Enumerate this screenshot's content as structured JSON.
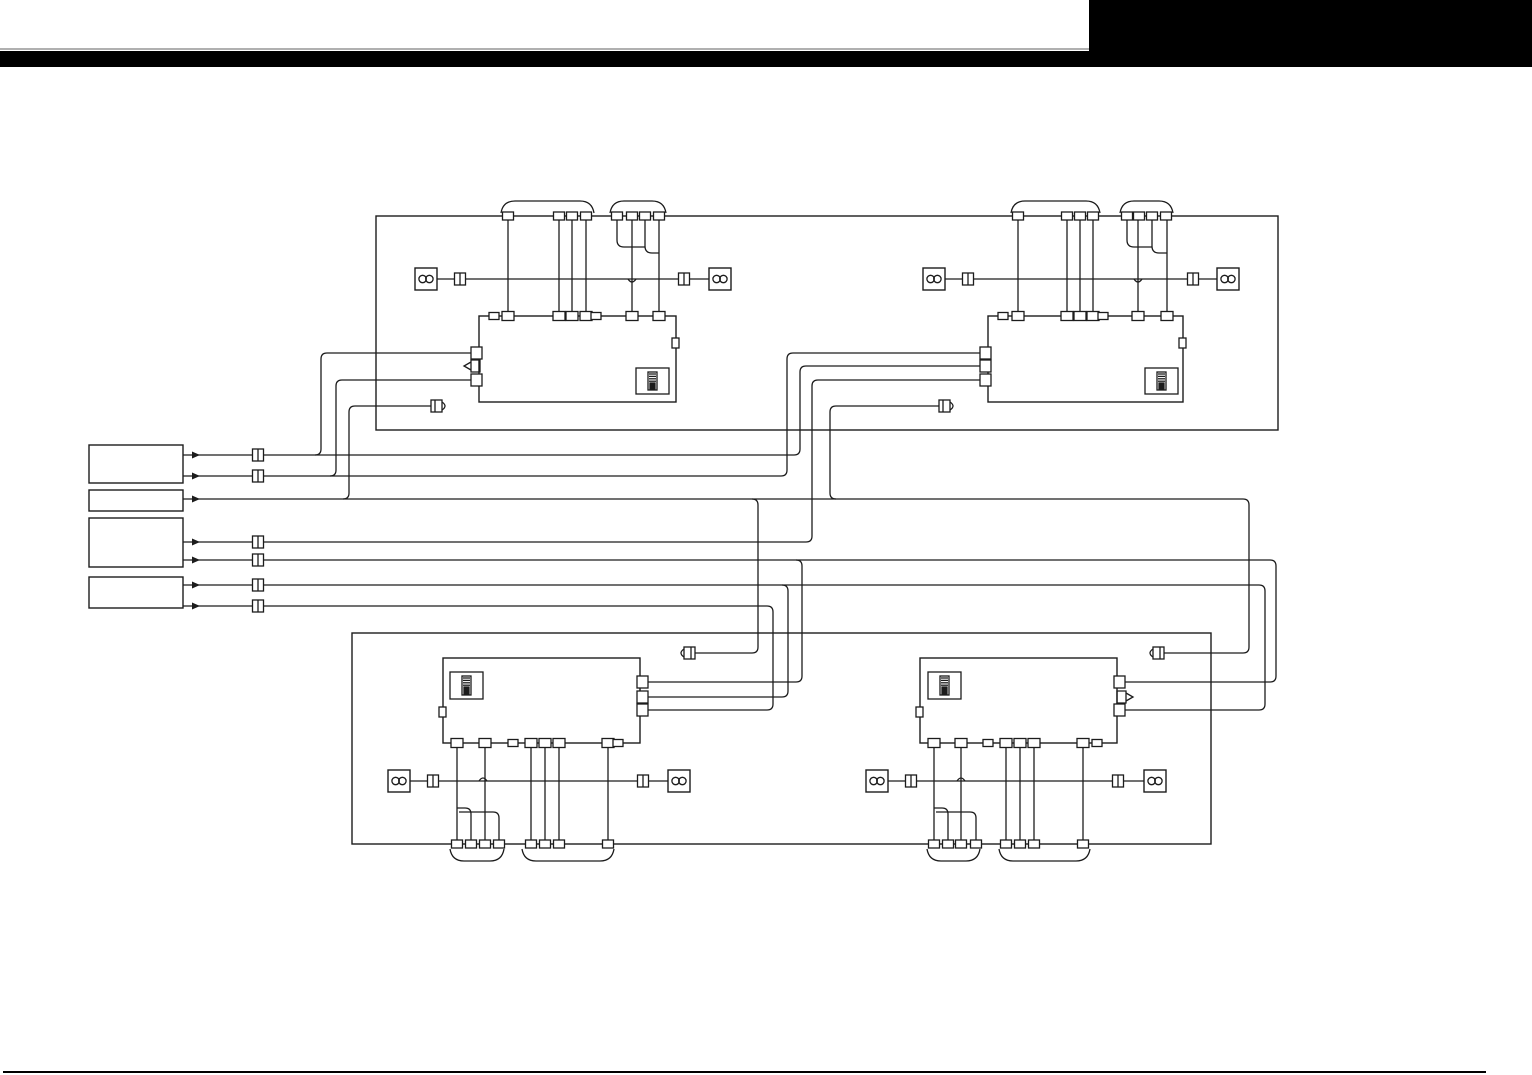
{
  "meta": {
    "width": 1532,
    "height": 1075,
    "description": "speaker-system-wiring-diagram"
  },
  "colors": {
    "background": "#ffffff",
    "line": "#1c1c1c",
    "header_black": "#000000",
    "rule_gray": "#b0b0b0"
  },
  "header": {
    "blocks": [
      {
        "name": "header-gray-rule",
        "x": 0,
        "y": 48,
        "w": 1089,
        "h": 2,
        "color": "#b0b0b0"
      },
      {
        "name": "header-black-bar",
        "x": 0,
        "y": 51,
        "w": 1532,
        "h": 16,
        "color": "#000000"
      },
      {
        "name": "header-corner-block",
        "x": 1089,
        "y": 0,
        "w": 443,
        "h": 67,
        "color": "#000000"
      }
    ]
  },
  "footer": {
    "blocks": [
      {
        "name": "footer-rule",
        "x": 3,
        "y": 1071,
        "w": 1483,
        "h": 2,
        "color": "#000000"
      }
    ]
  },
  "diagram": {
    "frames": [
      {
        "name": "top-harness-frame",
        "x": 376,
        "y": 216,
        "w": 902,
        "h": 214
      },
      {
        "name": "bottom-harness-frame",
        "x": 352,
        "y": 633,
        "w": 859,
        "h": 211
      }
    ],
    "units": [
      {
        "name": "unit-top-left",
        "x": 479,
        "y": 316,
        "w": 197,
        "h": 86,
        "inner_box": {
          "x": 636,
          "y": 368,
          "w": 33,
          "h": 26
        },
        "side_tab": {
          "x": 672,
          "y": 338,
          "w": 7,
          "h": 10
        }
      },
      {
        "name": "unit-top-right",
        "x": 988,
        "y": 316,
        "w": 195,
        "h": 86,
        "inner_box": {
          "x": 1145,
          "y": 368,
          "w": 33,
          "h": 26
        },
        "side_tab": {
          "x": 1179,
          "y": 338,
          "w": 7,
          "h": 10
        }
      },
      {
        "name": "unit-bottom-left",
        "x": 443,
        "y": 658,
        "w": 197,
        "h": 85,
        "inner_box": {
          "x": 450,
          "y": 672,
          "w": 33,
          "h": 27
        },
        "side_tab": {
          "x": 439,
          "y": 707,
          "w": 7,
          "h": 10
        }
      },
      {
        "name": "unit-bottom-right",
        "x": 920,
        "y": 658,
        "w": 197,
        "h": 85,
        "inner_box": {
          "x": 928,
          "y": 672,
          "w": 33,
          "h": 27
        },
        "side_tab": {
          "x": 916,
          "y": 707,
          "w": 7,
          "h": 10
        }
      }
    ],
    "source_boxes": [
      {
        "name": "source-box-1",
        "x": 89,
        "y": 445,
        "w": 94,
        "h": 38
      },
      {
        "name": "source-box-2",
        "x": 89,
        "y": 490,
        "w": 94,
        "h": 21
      },
      {
        "name": "source-box-3",
        "x": 89,
        "y": 518,
        "w": 94,
        "h": 49
      },
      {
        "name": "source-box-4",
        "x": 89,
        "y": 577,
        "w": 94,
        "h": 31
      }
    ],
    "wires": [
      {
        "name": "wire-tl-pin-a1",
        "d": "M508,216 V316"
      },
      {
        "name": "wire-tl-pin-a2",
        "d": "M559,216 V316"
      },
      {
        "name": "wire-tl-pin-a3",
        "d": "M572,216 V316"
      },
      {
        "name": "wire-tl-pin-a4",
        "d": "M586,216 V316"
      },
      {
        "name": "wire-tl-pin-b2",
        "d": "M632,216 V316"
      },
      {
        "name": "wire-tl-pin-b4",
        "d": "M659,216 V316"
      },
      {
        "name": "wire-tl-pin-b1-merge",
        "d": "M617,216 V240 Q617,247 624,247 H645"
      },
      {
        "name": "wire-tl-pin-b3-merge",
        "d": "M645,216 V246 Q645,253 652,253 H659"
      },
      {
        "name": "wire-tr-pin-a1",
        "d": "M1018,216 V316"
      },
      {
        "name": "wire-tr-pin-a2",
        "d": "M1067,216 V316"
      },
      {
        "name": "wire-tr-pin-a3",
        "d": "M1080,216 V316"
      },
      {
        "name": "wire-tr-pin-a4",
        "d": "M1093,216 V316"
      },
      {
        "name": "wire-tr-pin-b2",
        "d": "M1138,216 V316"
      },
      {
        "name": "wire-tr-pin-b4",
        "d": "M1167,216 V316"
      },
      {
        "name": "wire-tr-pin-b1-merge",
        "d": "M1127,216 V240 Q1127,247 1134,247 H1152"
      },
      {
        "name": "wire-tr-pin-b3-merge",
        "d": "M1152,216 V246 Q1152,253 1159,253 H1167"
      },
      {
        "name": "wire-bl-pin-1",
        "d": "M457,743 V844"
      },
      {
        "name": "wire-bl-pin-3",
        "d": "M485,743 V844"
      },
      {
        "name": "wire-bl-pin-2-merge",
        "d": "M471,844 V814 Q471,808 465,808 H457"
      },
      {
        "name": "wire-bl-pin-4-merge",
        "d": "M499,844 V818 Q499,812 493,812 H459"
      },
      {
        "name": "wire-bl-pin-c1",
        "d": "M531,743 V844"
      },
      {
        "name": "wire-bl-pin-c2",
        "d": "M545,743 V844"
      },
      {
        "name": "wire-bl-pin-c3",
        "d": "M559,743 V844"
      },
      {
        "name": "wire-bl-pin-c4",
        "d": "M608,743 V844"
      },
      {
        "name": "wire-br-pin-1",
        "d": "M934,743 V844"
      },
      {
        "name": "wire-br-pin-3",
        "d": "M961,743 V844"
      },
      {
        "name": "wire-br-pin-2-merge",
        "d": "M948,844 V814 Q948,808 942,808 H934"
      },
      {
        "name": "wire-br-pin-4-merge",
        "d": "M976,844 V818 Q976,812 970,812 H936"
      },
      {
        "name": "wire-br-pin-c1",
        "d": "M1006,743 V844"
      },
      {
        "name": "wire-br-pin-c2",
        "d": "M1020,743 V844"
      },
      {
        "name": "wire-br-pin-c3",
        "d": "M1034,743 V844"
      },
      {
        "name": "wire-br-pin-c4",
        "d": "M1083,743 V844"
      },
      {
        "name": "wire-speaker-row-tl-1",
        "d": "M437,279 H455"
      },
      {
        "name": "wire-speaker-row-tl-2",
        "d": "M466,279 H679"
      },
      {
        "name": "wire-speaker-row-tl-3",
        "d": "M690,279 H709"
      },
      {
        "name": "hop-tl",
        "d": "M628,279 Q632,285 636,279"
      },
      {
        "name": "wire-speaker-row-tr-1",
        "d": "M945,279 H963"
      },
      {
        "name": "wire-speaker-row-tr-2",
        "d": "M974,279 H1188"
      },
      {
        "name": "wire-speaker-row-tr-3",
        "d": "M1199,279 H1217"
      },
      {
        "name": "hop-tr",
        "d": "M1134,279 Q1138,285 1142,279"
      },
      {
        "name": "wire-speaker-row-bl-1",
        "d": "M409,781 H428"
      },
      {
        "name": "wire-speaker-row-bl-2",
        "d": "M439,781 H638"
      },
      {
        "name": "wire-speaker-row-bl-3",
        "d": "M649,781 H668"
      },
      {
        "name": "hop-bl",
        "d": "M479,781 Q483,775 487,781"
      },
      {
        "name": "wire-speaker-row-br-1",
        "d": "M887,781 H906"
      },
      {
        "name": "wire-speaker-row-br-2",
        "d": "M917,781 H1113"
      },
      {
        "name": "wire-speaker-row-br-3",
        "d": "M1124,781 H1144"
      },
      {
        "name": "hop-br",
        "d": "M957,781 Q961,775 965,781"
      },
      {
        "name": "net-source1-line1",
        "d": "M183,455 H794 Q800,455 800,449 V372 Q800,366 806,366 H980"
      },
      {
        "name": "net-source1-line1-branch",
        "d": "M315,455 Q321,455 321,449 V359 Q321,353 327,353 H472"
      },
      {
        "name": "net-source1-line2",
        "d": "M183,476 H781 Q787,476 787,470 V359 Q787,353 793,353 H980"
      },
      {
        "name": "net-source1-line2-branch",
        "d": "M330,476 Q336,476 336,470 V386 Q336,380 342,380 H472"
      },
      {
        "name": "net-source2-main",
        "d": "M183,499 H1243 Q1249,499 1249,505 V647 Q1249,653 1243,653 H1164"
      },
      {
        "name": "net-source2-branch-tl-plug",
        "d": "M343,499 Q349,499 349,493 V412 Q349,406 355,406 H431"
      },
      {
        "name": "net-source2-branch-bl-plug",
        "d": "M752,499 Q758,499 758,505 V647 Q758,653 752,653 H695"
      },
      {
        "name": "net-source2-branch-tr-plug",
        "d": "M836,499 Q830,499 830,493 V412 Q830,406 836,406 H939"
      },
      {
        "name": "net-source3-line1",
        "d": "M183,542 H806 Q812,542 812,536 V386 Q812,380 818,380 H980"
      },
      {
        "name": "net-source3-line2",
        "d": "M183,560 H1270 Q1276,560 1276,566 V676 Q1276,682 1270,682 H1124"
      },
      {
        "name": "net-source3-line2-branch",
        "d": "M796,560 Q802,560 802,566 V676 Q802,682 796,682 H646"
      },
      {
        "name": "net-source4-line1",
        "d": "M183,585 H1259 Q1265,585 1265,591 V704 Q1265,710 1259,710 H1124"
      },
      {
        "name": "net-source4-line1-branch",
        "d": "M782,585 Q788,585 788,591 V691 Q788,697 782,697 H646"
      },
      {
        "name": "net-source4-line2",
        "d": "M183,606 H767 Q773,606 773,612 V704 Q773,710 767,710 H646"
      }
    ],
    "arrows": [
      {
        "name": "flow-arrow-1",
        "x": 192,
        "y": 455
      },
      {
        "name": "flow-arrow-2",
        "x": 192,
        "y": 476
      },
      {
        "name": "flow-arrow-3",
        "x": 192,
        "y": 499
      },
      {
        "name": "flow-arrow-4",
        "x": 192,
        "y": 542
      },
      {
        "name": "flow-arrow-5",
        "x": 192,
        "y": 560
      },
      {
        "name": "flow-arrow-6",
        "x": 192,
        "y": 585
      },
      {
        "name": "flow-arrow-7",
        "x": 192,
        "y": 606
      }
    ],
    "edge_pins": [
      [
        508,
        216
      ],
      [
        559,
        216
      ],
      [
        572,
        216
      ],
      [
        586,
        216
      ],
      [
        617,
        216
      ],
      [
        632,
        216
      ],
      [
        645,
        216
      ],
      [
        659,
        216
      ],
      [
        1018,
        216
      ],
      [
        1067,
        216
      ],
      [
        1080,
        216
      ],
      [
        1093,
        216
      ],
      [
        1127,
        216
      ],
      [
        1139,
        216
      ],
      [
        1152,
        216
      ],
      [
        1166,
        216
      ],
      [
        457,
        844
      ],
      [
        471,
        844
      ],
      [
        485,
        844
      ],
      [
        499,
        844
      ],
      [
        531,
        844
      ],
      [
        545,
        844
      ],
      [
        559,
        844
      ],
      [
        608,
        844
      ],
      [
        934,
        844
      ],
      [
        948,
        844
      ],
      [
        961,
        844
      ],
      [
        976,
        844
      ],
      [
        1006,
        844
      ],
      [
        1020,
        844
      ],
      [
        1034,
        844
      ],
      [
        1083,
        844
      ]
    ],
    "unit_pins": [
      [
        508,
        316
      ],
      [
        559,
        316
      ],
      [
        572,
        316
      ],
      [
        586,
        316
      ],
      [
        632,
        316
      ],
      [
        659,
        316
      ],
      [
        1018,
        316
      ],
      [
        1067,
        316
      ],
      [
        1080,
        316
      ],
      [
        1093,
        316
      ],
      [
        1138,
        316
      ],
      [
        1167,
        316
      ],
      [
        457,
        743
      ],
      [
        485,
        743
      ],
      [
        531,
        743
      ],
      [
        545,
        743
      ],
      [
        559,
        743
      ],
      [
        608,
        743
      ],
      [
        934,
        743
      ],
      [
        961,
        743
      ],
      [
        1006,
        743
      ],
      [
        1020,
        743
      ],
      [
        1034,
        743
      ],
      [
        1083,
        743
      ]
    ],
    "unit_tabs": [
      [
        494,
        316
      ],
      [
        596,
        316
      ],
      [
        1003,
        316
      ],
      [
        1103,
        316
      ],
      [
        513,
        743
      ],
      [
        618,
        743
      ],
      [
        988,
        743
      ],
      [
        1097,
        743
      ]
    ],
    "side_connectors": [
      {
        "name": "unit-port-tl-1",
        "x": 479,
        "y": 353,
        "side": "left"
      },
      {
        "name": "unit-port-tl-3",
        "x": 479,
        "y": 380,
        "side": "left"
      },
      {
        "name": "unit-port-tr-1",
        "x": 988,
        "y": 353,
        "side": "left"
      },
      {
        "name": "unit-port-tr-2",
        "x": 988,
        "y": 366,
        "side": "left"
      },
      {
        "name": "unit-port-tr-3",
        "x": 988,
        "y": 380,
        "side": "left"
      },
      {
        "name": "unit-port-bl-1",
        "x": 640,
        "y": 682,
        "side": "right"
      },
      {
        "name": "unit-port-bl-2",
        "x": 640,
        "y": 697,
        "side": "right"
      },
      {
        "name": "unit-port-bl-3",
        "x": 640,
        "y": 710,
        "side": "right"
      },
      {
        "name": "unit-port-br-1",
        "x": 1117,
        "y": 682,
        "side": "right"
      },
      {
        "name": "unit-port-br-3",
        "x": 1117,
        "y": 710,
        "side": "right"
      }
    ],
    "stub_plugs": [
      {
        "name": "stub-plug-top-left-unit",
        "d": "M471,360 h9 v12 h-9 z M471,362 L464,366 L471,370"
      },
      {
        "name": "stub-plug-bottom-right-unit",
        "d": "M1117,691 h9 v12 h-9 z M1126,693 L1133,697 L1126,701"
      }
    ],
    "rca_plugs": [
      {
        "name": "rca-plug-top-left",
        "x": 431,
        "y": 400,
        "dir": "right"
      },
      {
        "name": "rca-plug-top-right",
        "x": 939,
        "y": 400,
        "dir": "right"
      },
      {
        "name": "rca-plug-bottom-left",
        "x": 684,
        "y": 647,
        "dir": "left"
      },
      {
        "name": "rca-plug-bottom-right",
        "x": 1153,
        "y": 647,
        "dir": "left"
      }
    ],
    "inline_connectors": [
      {
        "name": "inline-connector-src-1",
        "cx": 258,
        "cy": 455
      },
      {
        "name": "inline-connector-src-2",
        "cx": 258,
        "cy": 476
      },
      {
        "name": "inline-connector-src-3",
        "cx": 258,
        "cy": 542
      },
      {
        "name": "inline-connector-src-4",
        "cx": 258,
        "cy": 560
      },
      {
        "name": "inline-connector-src-5",
        "cx": 258,
        "cy": 585
      },
      {
        "name": "inline-connector-src-6",
        "cx": 258,
        "cy": 606
      },
      {
        "name": "inline-connector-spk-tl-a",
        "cx": 460,
        "cy": 279
      },
      {
        "name": "inline-connector-spk-tl-b",
        "cx": 684,
        "cy": 279
      },
      {
        "name": "inline-connector-spk-tr-a",
        "cx": 968,
        "cy": 279
      },
      {
        "name": "inline-connector-spk-tr-b",
        "cx": 1193,
        "cy": 279
      },
      {
        "name": "inline-connector-spk-bl-a",
        "cx": 433,
        "cy": 781
      },
      {
        "name": "inline-connector-spk-bl-b",
        "cx": 643,
        "cy": 781
      },
      {
        "name": "inline-connector-spk-br-a",
        "cx": 911,
        "cy": 781
      },
      {
        "name": "inline-connector-spk-br-b",
        "cx": 1118,
        "cy": 781
      }
    ],
    "speakers": [
      {
        "name": "speaker-top-left-a",
        "x": 415,
        "y": 268
      },
      {
        "name": "speaker-top-left-b",
        "x": 709,
        "y": 268
      },
      {
        "name": "speaker-top-right-a",
        "x": 923,
        "y": 268
      },
      {
        "name": "speaker-top-right-b",
        "x": 1217,
        "y": 268
      },
      {
        "name": "speaker-bottom-left-a",
        "x": 388,
        "y": 770
      },
      {
        "name": "speaker-bottom-left-b",
        "x": 668,
        "y": 770
      },
      {
        "name": "speaker-bottom-right-a",
        "x": 866,
        "y": 770
      },
      {
        "name": "speaker-bottom-right-b",
        "x": 1144,
        "y": 770
      }
    ],
    "brackets": [
      {
        "name": "bracket-tl-1",
        "d": "M501,213 Q503,201 515,201 H580 Q592,201 594,213"
      },
      {
        "name": "bracket-tl-2",
        "d": "M610,213 Q612,201 624,201 H652 Q664,201 666,213"
      },
      {
        "name": "bracket-tr-1",
        "d": "M1011,213 Q1013,201 1025,201 H1086 Q1098,201 1100,213"
      },
      {
        "name": "bracket-tr-2",
        "d": "M1120,213 Q1122,201 1134,201 H1159 Q1171,201 1173,213"
      },
      {
        "name": "bracket-bl-1",
        "d": "M450,849 Q452,861 464,861 H490 Q502,861 504,849"
      },
      {
        "name": "bracket-bl-2",
        "d": "M522,849 Q524,861 536,861 H600 Q612,861 614,849"
      },
      {
        "name": "bracket-br-1",
        "d": "M927,849 Q929,861 941,861 H966 Q978,861 980,849"
      },
      {
        "name": "bracket-br-2",
        "d": "M999,849 Q1001,861 1013,861 H1076 Q1088,861 1090,849"
      }
    ]
  }
}
